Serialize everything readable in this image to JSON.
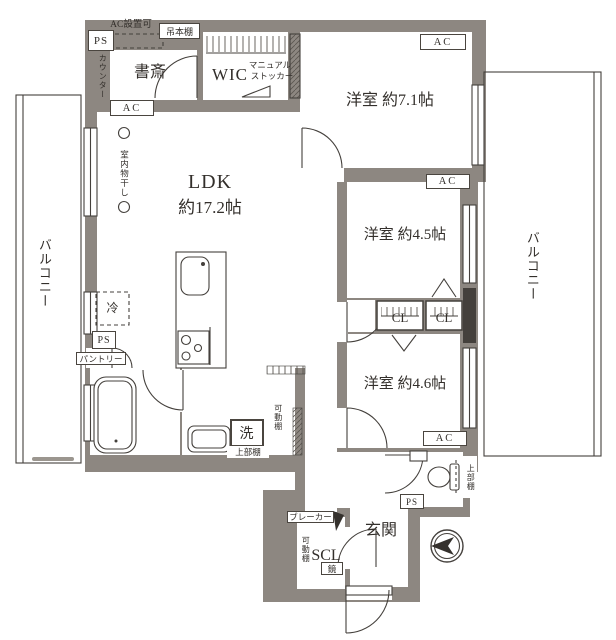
{
  "colors": {
    "wall": "#8d8781",
    "line": "#44403c",
    "floor": "#ffffff",
    "text": "#332f2b"
  },
  "rooms": {
    "ldk": "LDK",
    "ldk_size": "約17.2帖",
    "bedroom_71": "洋室 約7.1帖",
    "bedroom_45": "洋室 約4.5帖",
    "bedroom_46": "洋室 約4.6帖",
    "study": "書斎",
    "wic": "WIC",
    "scl": "SCL",
    "entrance": "玄関",
    "closet": "CL",
    "balcony": "バルコニー"
  },
  "labels": {
    "ps": "PS",
    "ac": "AC",
    "ac_installable": "AC設置可",
    "hanging_bookshelf": "吊本棚",
    "counter": "カウンター",
    "manual_stocker_line1": "マニュアル",
    "manual_stocker_line2": "ストッカー",
    "indoor_drying": "室内物干し",
    "fridge": "冷",
    "pantry": "パントリー",
    "washer": "洗",
    "upper_shelf": "上部棚",
    "movable_shelf": "可動棚",
    "breaker": "ブレーカー",
    "mirror": "鏡"
  }
}
